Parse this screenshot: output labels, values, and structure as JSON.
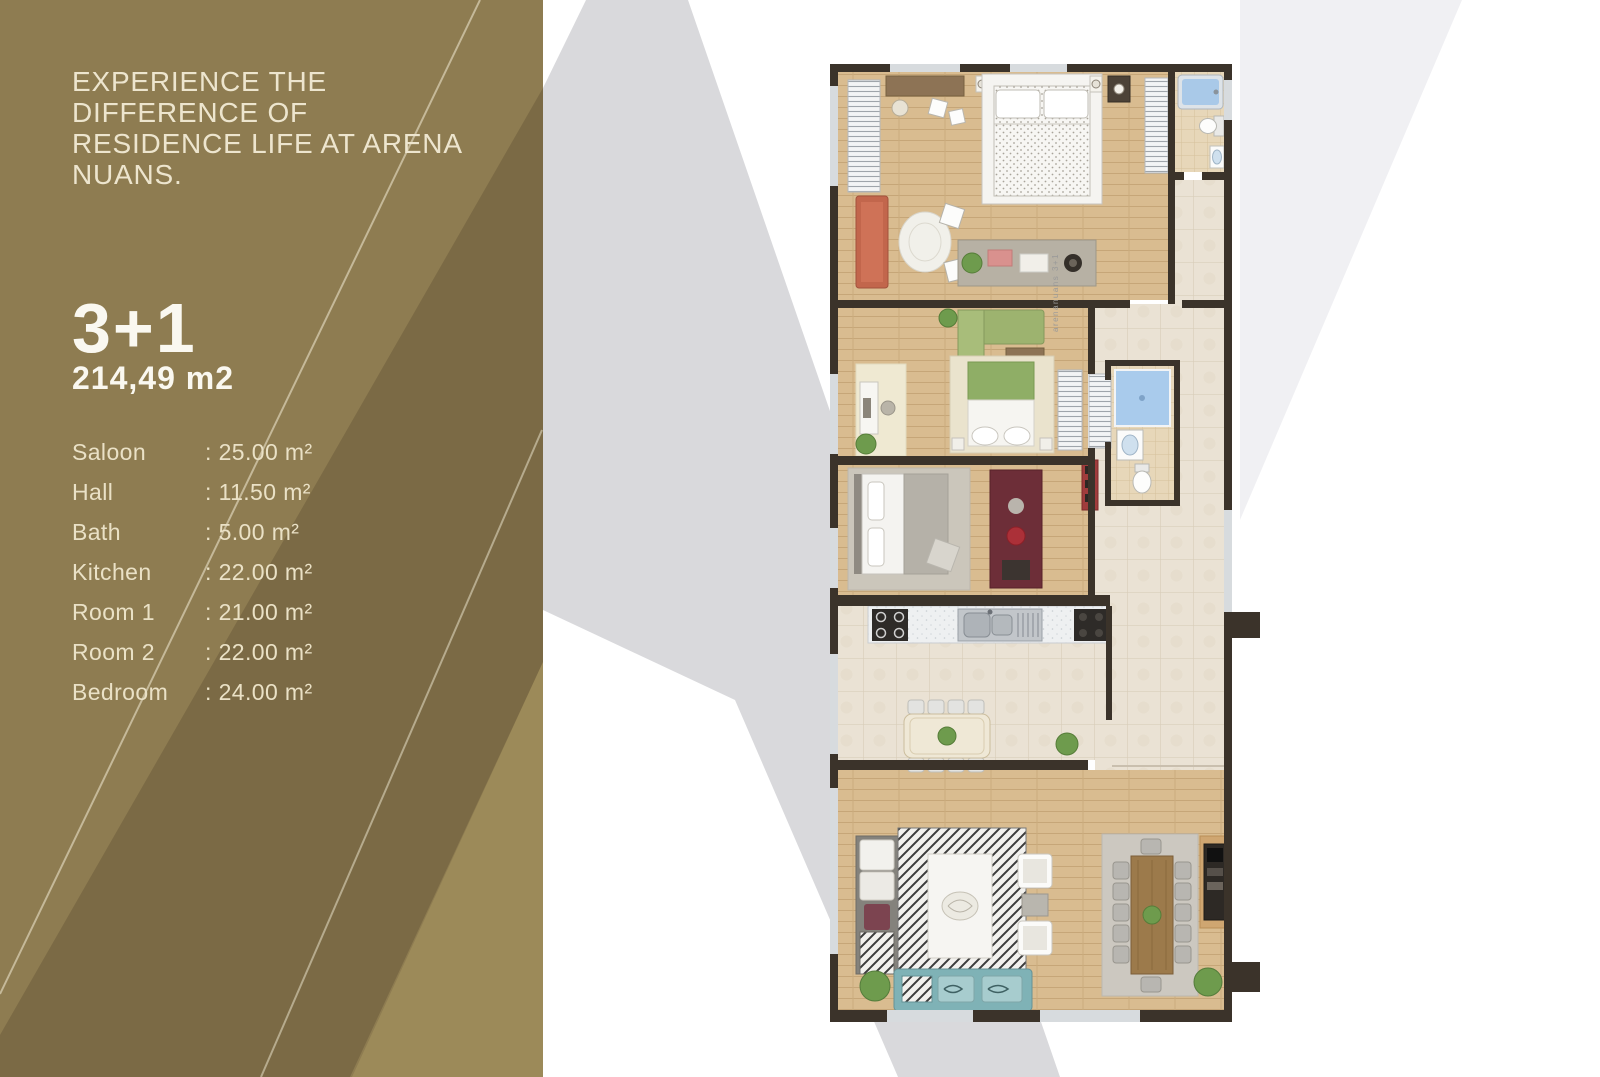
{
  "panel": {
    "heading_lines": [
      "EXPERIENCE THE",
      "DIFFERENCE OF",
      "RESIDENCE LIFE AT ARENA",
      "NUANS."
    ],
    "unit_type": "3+1",
    "unit_area": "214,49 m2",
    "rooms": [
      {
        "label": "Saloon",
        "value": ": 25.00 m²"
      },
      {
        "label": "Hall",
        "value": ": 11.50 m²"
      },
      {
        "label": "Bath",
        "value": ": 5.00 m²"
      },
      {
        "label": "Kitchen",
        "value": ": 22.00 m²"
      },
      {
        "label": "Room 1",
        "value": ": 21.00 m²"
      },
      {
        "label": "Room 2",
        "value": ": 22.00 m²"
      },
      {
        "label": "Bedroom",
        "value": ": 24.00 m²"
      }
    ],
    "colors": {
      "base": "#8E7C51",
      "band_dark": "#7B6A45",
      "band_light": "#9C8A59",
      "text": "#EDE5CE",
      "text_bright": "#FAF8F0"
    }
  },
  "watermark": {
    "color_main": "#D9D9DC",
    "color_faint": "#F0F0F3"
  },
  "plan": {
    "brand_label": "arenanuans 3+1",
    "colors": {
      "wall": "#3B332A",
      "wood": "#D9BC90",
      "tile": "#EAE2D4",
      "water_blue": "#A9C9E8"
    }
  }
}
